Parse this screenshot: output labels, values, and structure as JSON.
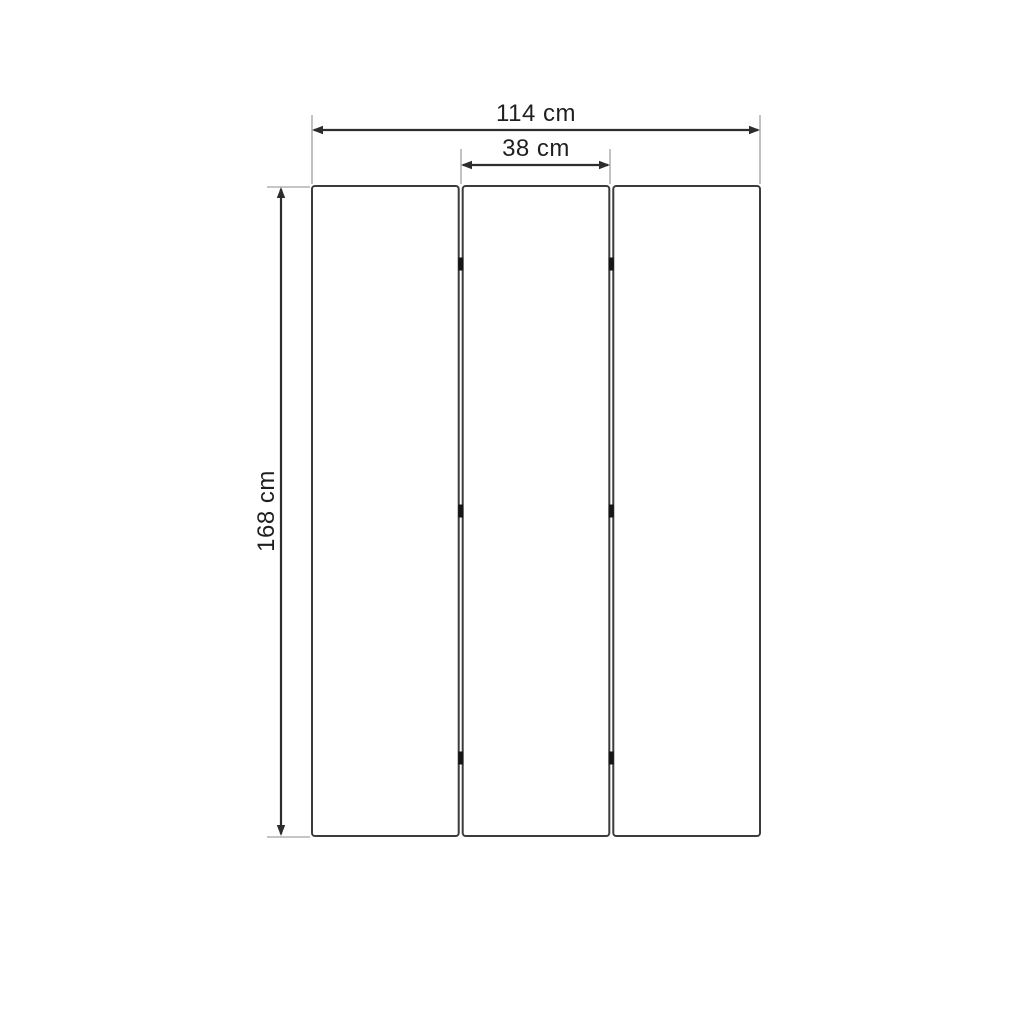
{
  "diagram": {
    "kind": "dimension-drawing",
    "object": "three-panel folding screen, front view",
    "labels": {
      "total_width": "114 cm",
      "panel_width": "38 cm",
      "height": "168 cm"
    },
    "panels": {
      "count": 3,
      "hinge_marks_per_gap": 3
    },
    "colors": {
      "background": "#ffffff",
      "panel_border": "#3c3c3c",
      "panel_fill": "#ffffff",
      "dimension_line": "#2d2d2d",
      "extension_line": "#b2b2b2",
      "hinge_mark": "#161616",
      "label_text": "#1f1f1f"
    }
  }
}
